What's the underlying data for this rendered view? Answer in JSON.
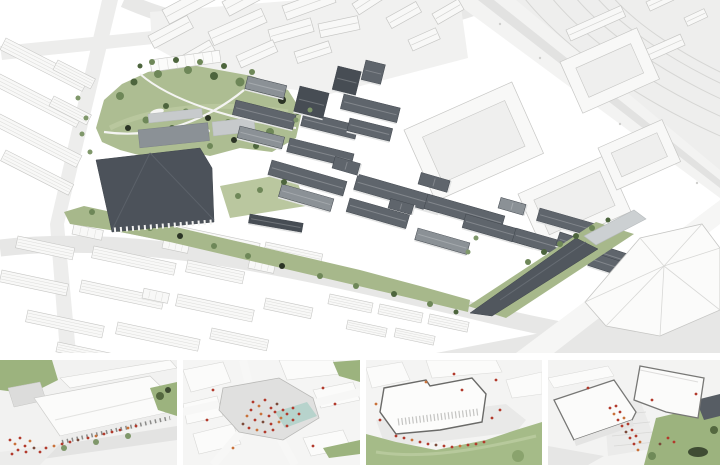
{
  "figure": {
    "kind": "architectural-masterplan-rendering",
    "main_view_label": "aerial-axonometric-masterplan",
    "thumbnail_labels": [
      "market-hall-street-view",
      "central-plaza-aerial",
      "park-edge-building",
      "gateway-plaza-buildings"
    ]
  },
  "colors": {
    "context": "#f8f8f7",
    "context-line": "#c7c7c5",
    "stripe": "#dcdcda",
    "ground-road": "#e7e7e6",
    "road-light": "#ededec",
    "track-area": "#eeeeed",
    "track-line": "#d6d6d4",
    "park": "#adbd92",
    "park-light": "#bac79f",
    "greenstrip": "#a7b88b",
    "lawn": "#a5bb88",
    "slope": "#9cb37e",
    "roof": "#5f656c",
    "roof-mid": "#8b9196",
    "roof-light": "#c7cacc",
    "roof-deep": "#474d54",
    "hall": "#4c525a",
    "wedge": "#51575e",
    "facade": "#e3e4e4",
    "water": "#b7d3cc",
    "people-red": "#b23a2c",
    "people-orange": "#c9713a",
    "people-dark": "#7a4a3a",
    "outline-dark": "#6a6a68"
  },
  "scene": {
    "context_slabs": [
      [
        6,
        38,
        92,
        13,
        27
      ],
      [
        0,
        74,
        92,
        13,
        27
      ],
      [
        0,
        114,
        92,
        13,
        27
      ],
      [
        6,
        150,
        76,
        12,
        27
      ],
      [
        58,
        60,
        42,
        11,
        27
      ],
      [
        54,
        96,
        42,
        11,
        27
      ],
      [
        86,
        212,
        84,
        12,
        12
      ],
      [
        178,
        226,
        84,
        12,
        12
      ],
      [
        266,
        242,
        58,
        11,
        12
      ],
      [
        18,
        236,
        58,
        12,
        12
      ],
      [
        94,
        246,
        84,
        12,
        12
      ],
      [
        188,
        260,
        58,
        12,
        12
      ],
      [
        2,
        270,
        68,
        12,
        12
      ],
      [
        82,
        280,
        84,
        12,
        12
      ],
      [
        178,
        294,
        78,
        12,
        12
      ],
      [
        266,
        298,
        48,
        11,
        12
      ],
      [
        28,
        310,
        78,
        12,
        12
      ],
      [
        118,
        322,
        84,
        12,
        12
      ],
      [
        212,
        328,
        58,
        11,
        12
      ],
      [
        58,
        342,
        68,
        10,
        12
      ],
      [
        330,
        294,
        44,
        10,
        12
      ],
      [
        380,
        304,
        44,
        10,
        12
      ],
      [
        430,
        314,
        40,
        10,
        12
      ],
      [
        348,
        320,
        40,
        9,
        12
      ],
      [
        396,
        328,
        40,
        9,
        12
      ],
      [
        72,
        234,
        10,
        30,
        -78
      ],
      [
        162,
        248,
        10,
        26,
        -78
      ],
      [
        248,
        268,
        10,
        26,
        -78
      ],
      [
        142,
        298,
        10,
        26,
        -78
      ]
    ],
    "context_gables": [
      [
        162,
        10,
        56,
        16,
        -28
      ],
      [
        222,
        2,
        50,
        16,
        -28
      ],
      [
        282,
        6,
        52,
        15,
        -20
      ],
      [
        148,
        36,
        44,
        14,
        -28
      ],
      [
        208,
        32,
        58,
        15,
        -24
      ],
      [
        268,
        30,
        44,
        14,
        -16
      ],
      [
        318,
        24,
        40,
        14,
        -12
      ],
      [
        352,
        4,
        40,
        13,
        -33
      ],
      [
        386,
        18,
        34,
        12,
        -29
      ],
      [
        236,
        56,
        40,
        13,
        -24
      ],
      [
        294,
        52,
        36,
        12,
        -18
      ],
      [
        178,
        58,
        36,
        12,
        -30
      ],
      [
        408,
        40,
        30,
        12,
        -24
      ],
      [
        432,
        14,
        30,
        12,
        -30
      ],
      [
        566,
        30,
        60,
        12,
        -24
      ],
      [
        640,
        52,
        44,
        12,
        -24
      ],
      [
        646,
        2,
        26,
        10,
        -25
      ],
      [
        684,
        18,
        22,
        9,
        -25
      ]
    ],
    "courtyards": [
      [
        404,
        130,
        118,
        78,
        -24,
        14
      ],
      [
        518,
        194,
        96,
        62,
        -24,
        12
      ],
      [
        598,
        148,
        70,
        46,
        -24,
        10
      ],
      [
        560,
        62,
        84,
        56,
        -24,
        12
      ]
    ],
    "dark_bars": [
      [
        236,
        100,
        62,
        15,
        14,
        "dark"
      ],
      [
        304,
        112,
        56,
        14,
        14,
        "dark"
      ],
      [
        240,
        126,
        46,
        12,
        14,
        "mid"
      ],
      [
        300,
        86,
        30,
        26,
        14,
        "deep"
      ],
      [
        338,
        66,
        24,
        24,
        14,
        "deep"
      ],
      [
        366,
        60,
        20,
        20,
        14,
        "dark"
      ],
      [
        344,
        94,
        58,
        15,
        14,
        "dark"
      ],
      [
        350,
        118,
        44,
        13,
        14,
        "dark"
      ],
      [
        290,
        138,
        66,
        14,
        14,
        "dark"
      ],
      [
        248,
        76,
        40,
        13,
        14,
        "mid"
      ],
      [
        272,
        160,
        78,
        15,
        16,
        "dark"
      ],
      [
        358,
        174,
        88,
        16,
        16,
        "dark"
      ],
      [
        282,
        184,
        54,
        13,
        16,
        "mid"
      ],
      [
        350,
        198,
        62,
        14,
        16,
        "dark"
      ],
      [
        428,
        194,
        80,
        15,
        16,
        "dark"
      ],
      [
        466,
        214,
        74,
        14,
        16,
        "dark"
      ],
      [
        418,
        228,
        54,
        12,
        16,
        "mid"
      ],
      [
        516,
        228,
        66,
        14,
        16,
        "dark"
      ],
      [
        540,
        208,
        58,
        13,
        16,
        "dark"
      ],
      [
        332,
        168,
        12,
        26,
        -74,
        "dark"
      ],
      [
        418,
        184,
        12,
        30,
        -74,
        "dark"
      ],
      [
        498,
        208,
        11,
        26,
        -74,
        "mid"
      ],
      [
        388,
        208,
        10,
        24,
        -74,
        "dark"
      ],
      [
        560,
        232,
        76,
        14,
        18,
        "dark"
      ],
      [
        592,
        252,
        78,
        14,
        18,
        "dark"
      ],
      [
        628,
        272,
        60,
        12,
        18,
        "mid"
      ],
      [
        652,
        238,
        40,
        12,
        18,
        "dark"
      ],
      [
        620,
        292,
        40,
        11,
        18,
        "dark"
      ],
      [
        250,
        214,
        54,
        9,
        10,
        "deep"
      ]
    ],
    "park_trees": [
      [
        120,
        96,
        4,
        1
      ],
      [
        134,
        82,
        3.5,
        2
      ],
      [
        158,
        74,
        4,
        1
      ],
      [
        188,
        70,
        4,
        1
      ],
      [
        214,
        76,
        4,
        2
      ],
      [
        240,
        82,
        4.5,
        1
      ],
      [
        262,
        90,
        4,
        1
      ],
      [
        282,
        100,
        4,
        3
      ],
      [
        288,
        118,
        4,
        1
      ],
      [
        270,
        132,
        4,
        1
      ],
      [
        250,
        128,
        3.5,
        2
      ],
      [
        228,
        122,
        3,
        1
      ],
      [
        208,
        118,
        3,
        3
      ],
      [
        186,
        112,
        3.5,
        1
      ],
      [
        166,
        106,
        3,
        2
      ],
      [
        146,
        120,
        3.5,
        1
      ],
      [
        128,
        128,
        3,
        3
      ],
      [
        150,
        140,
        3.5,
        3
      ],
      [
        172,
        128,
        3,
        2
      ],
      [
        234,
        140,
        3,
        3
      ],
      [
        210,
        146,
        3,
        1
      ],
      [
        256,
        146,
        3,
        2
      ],
      [
        298,
        112,
        3,
        2
      ],
      [
        276,
        86,
        3,
        2
      ],
      [
        252,
        72,
        3,
        1
      ],
      [
        224,
        66,
        3,
        2
      ],
      [
        200,
        62,
        3,
        1
      ],
      [
        176,
        60,
        3,
        2
      ],
      [
        152,
        62,
        3,
        1
      ],
      [
        140,
        66,
        2.5,
        2
      ]
    ],
    "strip_trees": [
      [
        92,
        212,
        3,
        1
      ],
      [
        116,
        220,
        3,
        2
      ],
      [
        150,
        228,
        3,
        1
      ],
      [
        180,
        236,
        3,
        3
      ],
      [
        214,
        246,
        3,
        1
      ],
      [
        248,
        256,
        3,
        1
      ],
      [
        282,
        266,
        3,
        3
      ],
      [
        320,
        276,
        3,
        1
      ],
      [
        356,
        286,
        3,
        1
      ],
      [
        394,
        294,
        3,
        2
      ],
      [
        430,
        304,
        3,
        1
      ],
      [
        456,
        312,
        2.5,
        2
      ]
    ],
    "street_trees": [
      [
        86,
        118,
        2.5,
        4
      ],
      [
        82,
        134,
        2.5,
        4
      ],
      [
        90,
        152,
        2.5,
        4
      ],
      [
        78,
        98,
        2.5,
        4
      ],
      [
        296,
        120,
        2.5,
        4
      ],
      [
        310,
        110,
        2.5,
        4
      ],
      [
        238,
        196,
        3,
        1
      ],
      [
        260,
        190,
        3,
        1
      ],
      [
        284,
        182,
        3,
        2
      ],
      [
        468,
        252,
        2.5,
        4
      ],
      [
        476,
        238,
        2.5,
        4
      ]
    ],
    "wedge_trees": [
      [
        528,
        262,
        3,
        1
      ],
      [
        544,
        252,
        3,
        2
      ],
      [
        560,
        244,
        3,
        1
      ],
      [
        576,
        236,
        3,
        2
      ],
      [
        592,
        228,
        3,
        1
      ],
      [
        608,
        220,
        2.5,
        2
      ]
    ],
    "track_dots": [
      [
        500,
        24
      ],
      [
        540,
        58
      ],
      [
        580,
        92
      ],
      [
        620,
        124
      ],
      [
        660,
        155
      ],
      [
        697,
        183
      ]
    ]
  },
  "thumbs": {
    "t1": {
      "people": [
        [
          10,
          80,
          "r"
        ],
        [
          15,
          84,
          "o"
        ],
        [
          20,
          78,
          "r"
        ],
        [
          25,
          86,
          "r"
        ],
        [
          30,
          81,
          "o"
        ],
        [
          18,
          90,
          "r"
        ],
        [
          26,
          92,
          "r"
        ],
        [
          34,
          88,
          "d"
        ],
        [
          40,
          92,
          "r"
        ],
        [
          12,
          94,
          "r"
        ],
        [
          46,
          88,
          "r"
        ],
        [
          54,
          86,
          "o"
        ],
        [
          62,
          84,
          "r"
        ],
        [
          70,
          82,
          "r"
        ],
        [
          78,
          80,
          "d"
        ],
        [
          88,
          78,
          "r"
        ],
        [
          96,
          76,
          "o"
        ],
        [
          104,
          74,
          "r"
        ],
        [
          112,
          72,
          "r"
        ],
        [
          120,
          70,
          "r"
        ],
        [
          128,
          68,
          "o"
        ],
        [
          136,
          66,
          "r"
        ]
      ]
    },
    "t2": {
      "people": [
        [
          70,
          42,
          "r"
        ],
        [
          76,
          46,
          "o"
        ],
        [
          82,
          40,
          "r"
        ],
        [
          88,
          48,
          "r"
        ],
        [
          94,
          44,
          "d"
        ],
        [
          100,
          50,
          "r"
        ],
        [
          78,
          54,
          "o"
        ],
        [
          86,
          56,
          "r"
        ],
        [
          92,
          52,
          "r"
        ],
        [
          98,
          58,
          "o"
        ],
        [
          104,
          54,
          "r"
        ],
        [
          72,
          60,
          "r"
        ],
        [
          80,
          62,
          "d"
        ],
        [
          88,
          64,
          "r"
        ],
        [
          96,
          62,
          "o"
        ],
        [
          104,
          66,
          "r"
        ],
        [
          110,
          60,
          "r"
        ],
        [
          68,
          50,
          "r"
        ],
        [
          64,
          56,
          "o"
        ],
        [
          110,
          48,
          "r"
        ],
        [
          116,
          54,
          "r"
        ],
        [
          60,
          64,
          "d"
        ],
        [
          66,
          68,
          "r"
        ],
        [
          74,
          70,
          "o"
        ],
        [
          82,
          72,
          "r"
        ],
        [
          90,
          70,
          "r"
        ],
        [
          30,
          30,
          "r"
        ],
        [
          140,
          28,
          "r"
        ],
        [
          50,
          88,
          "o"
        ],
        [
          130,
          86,
          "r"
        ],
        [
          152,
          44,
          "r"
        ],
        [
          24,
          60,
          "r"
        ]
      ]
    },
    "t3": {
      "people": [
        [
          30,
          76,
          "r"
        ],
        [
          38,
          78,
          "r"
        ],
        [
          46,
          80,
          "o"
        ],
        [
          54,
          82,
          "r"
        ],
        [
          62,
          84,
          "r"
        ],
        [
          70,
          85,
          "d"
        ],
        [
          78,
          86,
          "r"
        ],
        [
          86,
          87,
          "r"
        ],
        [
          94,
          86,
          "o"
        ],
        [
          102,
          85,
          "r"
        ],
        [
          110,
          84,
          "r"
        ],
        [
          118,
          82,
          "r"
        ],
        [
          14,
          60,
          "r"
        ],
        [
          10,
          44,
          "o"
        ],
        [
          126,
          58,
          "r"
        ],
        [
          134,
          50,
          "r"
        ],
        [
          96,
          30,
          "r"
        ],
        [
          60,
          22,
          "o"
        ],
        [
          130,
          20,
          "r"
        ],
        [
          88,
          14,
          "r"
        ]
      ]
    },
    "t4": {
      "people": [
        [
          62,
          48,
          "r"
        ],
        [
          66,
          54,
          "o"
        ],
        [
          70,
          60,
          "r"
        ],
        [
          74,
          66,
          "r"
        ],
        [
          78,
          72,
          "d"
        ],
        [
          82,
          78,
          "r"
        ],
        [
          86,
          84,
          "r"
        ],
        [
          90,
          90,
          "o"
        ],
        [
          68,
          46,
          "r"
        ],
        [
          72,
          52,
          "r"
        ],
        [
          76,
          58,
          "o"
        ],
        [
          80,
          64,
          "r"
        ],
        [
          84,
          70,
          "r"
        ],
        [
          88,
          76,
          "r"
        ],
        [
          92,
          82,
          "o"
        ],
        [
          120,
          78,
          "r"
        ],
        [
          126,
          82,
          "r"
        ],
        [
          112,
          84,
          "d"
        ],
        [
          104,
          40,
          "r"
        ],
        [
          40,
          28,
          "r"
        ],
        [
          148,
          34,
          "r"
        ]
      ]
    }
  }
}
